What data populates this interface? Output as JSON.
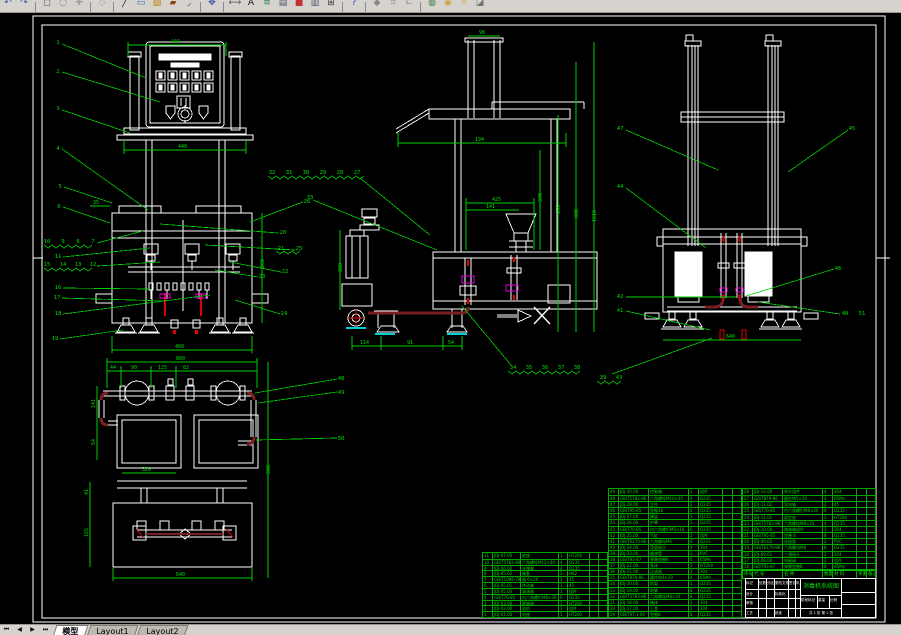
{
  "toolbar": {
    "icons": [
      {
        "name": "undo-icon",
        "glyph": "↶",
        "color": "#3a56a8"
      },
      {
        "name": "redo-icon",
        "glyph": "↷",
        "color": "#3a56a8"
      },
      {
        "sep": true
      },
      {
        "name": "zoom-window-icon",
        "glyph": "◻",
        "color": "#555555"
      },
      {
        "name": "zoom-realtime-icon",
        "glyph": "◌",
        "color": "#555555"
      },
      {
        "name": "pan-icon",
        "glyph": "✛",
        "color": "#777777"
      },
      {
        "sep": true
      },
      {
        "name": "snap-icon",
        "glyph": "◇",
        "color": "#9aa0a8"
      },
      {
        "sep": true
      },
      {
        "name": "line-icon",
        "glyph": "╱",
        "color": "#222222"
      },
      {
        "name": "rect-icon",
        "glyph": "▭",
        "color": "#2b6cb0"
      },
      {
        "name": "hatch-icon",
        "glyph": "▨",
        "color": "#b8860b"
      },
      {
        "name": "erase-icon",
        "glyph": "▰",
        "color": "#8b4513"
      },
      {
        "name": "fillet-icon",
        "glyph": "◞",
        "color": "#444444"
      },
      {
        "sep": true
      },
      {
        "name": "move-icon",
        "glyph": "✥",
        "color": "#2b4aa0"
      },
      {
        "sep": true
      },
      {
        "name": "dimension-icon",
        "glyph": "⟷",
        "color": "#555555"
      },
      {
        "name": "text-icon",
        "glyph": "A",
        "color": "#111111"
      },
      {
        "name": "layer-icon",
        "glyph": "≡",
        "color": "#2f855a"
      },
      {
        "name": "layers-icon",
        "glyph": "▤",
        "color": "#4a5568"
      },
      {
        "name": "color-icon",
        "glyph": "■",
        "color": "#c53030"
      },
      {
        "name": "properties-icon",
        "glyph": "▥",
        "color": "#4a5568"
      },
      {
        "name": "table-icon",
        "glyph": "⊞",
        "color": "#333333"
      },
      {
        "sep": true
      },
      {
        "name": "help-icon",
        "glyph": "?",
        "color": "#1a3faa"
      },
      {
        "sep": true
      },
      {
        "name": "osnap-icon",
        "glyph": "◆",
        "color": "#888888"
      },
      {
        "name": "grid-icon",
        "glyph": "⌗",
        "color": "#888888"
      },
      {
        "name": "ortho-icon",
        "glyph": "∟",
        "color": "#888888"
      },
      {
        "sep": true
      },
      {
        "name": "render-icon",
        "glyph": "◍",
        "color": "#3a7a3a"
      },
      {
        "name": "view-icon",
        "glyph": "◉",
        "color": "#caa53d"
      },
      {
        "name": "sun-icon",
        "glyph": "☼",
        "color": "#caa53d"
      },
      {
        "name": "material-icon",
        "glyph": "◪",
        "color": "#777777"
      }
    ]
  },
  "tabs": {
    "nav": [
      "⏮",
      "◀",
      "▶",
      "⏭"
    ],
    "items": [
      {
        "label": "模型",
        "active": true
      },
      {
        "label": "Layout1",
        "active": false
      },
      {
        "label": "Layout2",
        "active": false
      }
    ]
  },
  "colors": {
    "cad_line": "#ffffff",
    "dim_green": "#00d000",
    "pipe_darkred": "#7a1f1f",
    "accent_red": "#e00000",
    "accent_magenta": "#e000e0",
    "accent_cyan": "#00d0d0"
  },
  "front_view": {
    "balloons": {
      "left": [
        "1",
        "2",
        "3",
        "4",
        "5",
        "6"
      ],
      "rowA": [
        "10",
        "9",
        "8",
        "7"
      ],
      "b11": "11",
      "rowB": [
        "15",
        "14",
        "13",
        "12"
      ],
      "b16": "16",
      "b17": "17",
      "b18": "18",
      "b19": "19",
      "b26": "26",
      "b20": "20",
      "b21": "21",
      "b25": "25",
      "b22": "22",
      "b23": "23",
      "b24": "24"
    },
    "dims": {
      "top": "444",
      "mid": "440",
      "bottom": "460",
      "side": "260",
      "small": "35"
    }
  },
  "side_view": {
    "balloons_top": [
      "32",
      "31",
      "30",
      "29",
      "28",
      "27"
    ],
    "b33": "33",
    "balloons_bottom": [
      "34",
      "35",
      "36",
      "37",
      "38"
    ],
    "b39": "39",
    "b43": "43",
    "dims": {
      "cap": "98",
      "width": "194",
      "inner1": "425",
      "inner2": "141",
      "v1": "370",
      "v2": "655",
      "v3": "880",
      "v4": "1510",
      "b1": "114",
      "b2": "91",
      "b3": "54",
      "left": "288"
    }
  },
  "rear_view": {
    "balloons": {
      "b47": "47",
      "b45": "45",
      "b44": "44",
      "b42": "42",
      "b41": "41",
      "b46": "46",
      "b40": "40",
      "b51": "51"
    },
    "dims": {
      "bottom": "640"
    }
  },
  "plan_view": {
    "balloons": {
      "b48": "48",
      "b49": "49",
      "b50": "50"
    },
    "dims": {
      "top": "800",
      "s1": "44",
      "s2": "90",
      "s3": "125",
      "s4": "82",
      "l1": "141",
      "l2": "54",
      "l3": "41",
      "l4": "165",
      "inner": "320",
      "bottom": "640",
      "right": "508"
    }
  },
  "bom_right": {
    "header": [
      "序号",
      "代 号",
      "名 称",
      "数量",
      "材 料",
      "单重",
      "备注"
    ],
    "rows": [
      [
        "28",
        "JDJ-12.00",
        "喷头组件",
        "4",
        "304",
        "",
        " "
      ],
      [
        "27",
        "GB/T879-86",
        "圆柱销5×30",
        "4",
        "65Mn",
        "",
        " "
      ],
      [
        "26",
        "JDJ-11.02",
        "导向轴",
        "2",
        "45",
        "",
        " "
      ],
      [
        "25",
        "GB/T70-85",
        "内六角螺钉M6×20",
        "8",
        "Q235",
        "",
        " "
      ],
      [
        "24",
        "JDJ-11.01",
        "固定座",
        "2",
        "HT200",
        "",
        " "
      ],
      [
        "23",
        "GB/T5782-86",
        "六角螺栓M8×25",
        "4",
        "Q235",
        "",
        " "
      ],
      [
        "22",
        "JDJ-10.00",
        "储液箱组件",
        "1",
        "304",
        "",
        " "
      ],
      [
        "21",
        "GB/T95-85",
        "垫圈 8",
        "8",
        "Q235",
        "",
        " "
      ],
      [
        "20",
        "JDJ-09.02",
        "连接管",
        "2",
        "PVC",
        "",
        " "
      ],
      [
        "19",
        "GB/T6170-86",
        "六角螺母M8",
        "8",
        "Q235",
        "",
        " "
      ],
      [
        "18",
        "JDJ-09.01",
        "三通接头",
        "2",
        "304",
        "",
        " "
      ],
      [
        "17",
        "JDJ-08.00",
        "电磁阀",
        "2",
        "组件",
        "",
        " "
      ],
      [
        "16",
        "GB/T93-87",
        "弹簧垫圈8",
        "8",
        "65Mn",
        "",
        " "
      ]
    ]
  },
  "bom_left": {
    "rows": [
      [
        "49",
        "JDJ-30.00",
        "控制箱",
        "1",
        "组件",
        "",
        " "
      ],
      [
        "48",
        "GB/T5782-86",
        "六角螺栓M10×35",
        "4",
        "Q235",
        "",
        " "
      ],
      [
        "47",
        "JDJ-28.00",
        "立柱",
        "2",
        "Q235",
        "",
        " "
      ],
      [
        "46",
        "GB/T95-85",
        "垫圈10",
        "4",
        "Q235",
        "",
        " "
      ],
      [
        "45",
        "JDJ-27.00",
        "横梁",
        "1",
        "Q235",
        "",
        " "
      ],
      [
        "44",
        "JDJ-26.00",
        "护罩",
        "1",
        "Q235",
        "",
        " "
      ],
      [
        "43",
        "GB/T70-85",
        "内六角螺钉M5×16",
        "6",
        "Q235",
        "",
        " "
      ],
      [
        "42",
        "JDJ-25.00",
        "气缸",
        "2",
        "组件",
        "",
        " "
      ],
      [
        "41",
        "GB/T6170-86",
        "六角螺母M6",
        "6",
        "Q235",
        "",
        " "
      ],
      [
        "40",
        "JDJ-24.00",
        "弯管接头",
        "4",
        "304",
        "",
        " "
      ],
      [
        "39",
        "JDJ-23.00",
        "输液管",
        "2",
        "PVC",
        "",
        " "
      ],
      [
        "38",
        "GB/T93-87",
        "弹簧垫圈6",
        "6",
        "65Mn",
        "",
        " "
      ],
      [
        "37",
        "JDJ-22.00",
        "泵体",
        "2",
        "HT200",
        "",
        " "
      ],
      [
        "36",
        "JDJ-21.00",
        "过滤器",
        "2",
        "304",
        "",
        " "
      ],
      [
        "35",
        "GB/T879-86",
        "圆柱销4×20",
        "4",
        "65Mn",
        "",
        " "
      ],
      [
        "34",
        "JDJ-20.00",
        "机架",
        "1",
        "Q235",
        "",
        " "
      ],
      [
        "33",
        "JDJ-19.00",
        "地脚",
        "8",
        "Q235",
        "",
        " "
      ],
      [
        "32",
        "GB/T5783-86",
        "六角螺栓M8×20",
        "8",
        "Q235",
        "",
        " "
      ],
      [
        "31",
        "JDJ-18.00",
        "箱体",
        "1",
        "304",
        "",
        " "
      ],
      [
        "30",
        "JDJ-17.00",
        "上盖",
        "1",
        "304",
        "",
        " "
      ],
      [
        "29",
        "GB/T97.1-85",
        "垫圈8",
        "8",
        "Q235",
        "",
        " "
      ]
    ]
  },
  "bom_small": {
    "rows": [
      [
        "11",
        "JDJ-07.00",
        "底座",
        "1",
        "HT200",
        "",
        " "
      ],
      [
        "10",
        "GB/T5782-86",
        "六角螺栓M12×40",
        "4",
        "Q235",
        "",
        " "
      ],
      [
        "9",
        "JDJ-06.00",
        "支撑腿",
        "4",
        "Q235",
        "",
        " "
      ],
      [
        "8",
        "JDJ-05.02",
        "轴套",
        "2",
        "H62",
        "",
        " "
      ],
      [
        "7",
        "GB/T1096-79",
        "键 6×20",
        "2",
        "45",
        "",
        " "
      ],
      [
        "6",
        "JDJ-05.01",
        "传动轴",
        "1",
        "45",
        "",
        " "
      ],
      [
        "5",
        "JDJ-05.00",
        "减速器",
        "1",
        "组件",
        "",
        " "
      ],
      [
        "4",
        "GB/T70-85",
        "内六角螺钉M8×30",
        "6",
        "Q235",
        "",
        " "
      ],
      [
        "3",
        "JDJ-03.00",
        "联轴器",
        "1",
        "HT200",
        "",
        " "
      ],
      [
        "2",
        "JDJ-02.00",
        "电机",
        "1",
        "组件",
        "",
        " "
      ],
      [
        "1",
        "JDJ-01.00",
        "机座",
        "1",
        "HT200",
        "",
        " "
      ]
    ]
  },
  "title_block": {
    "title": "消毒机系统图",
    "left_rows": [
      [
        "标记",
        "处数",
        "分区",
        "更改文件号",
        "签名",
        "年月日"
      ],
      [
        "设计",
        "",
        "",
        "标准化",
        "",
        ""
      ],
      [
        "审核",
        "",
        "",
        "",
        "",
        ""
      ],
      [
        "工艺",
        "",
        "",
        "批准",
        "",
        ""
      ]
    ],
    "stage_row": [
      "阶段标记",
      "重量",
      "比例"
    ],
    "sheet_line": "共 1 张 第 1 张"
  }
}
